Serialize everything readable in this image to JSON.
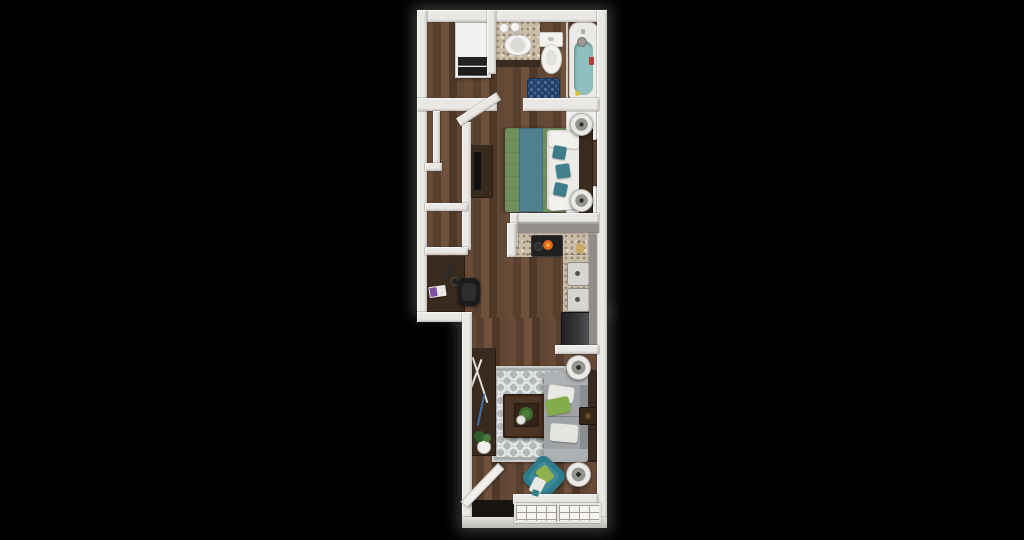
{
  "scene": {
    "description": "Top-down 3D rendered floor plan of a narrow studio apartment centered on a black background",
    "background": "#000000"
  },
  "palette": {
    "wall_white": "#eae8e5",
    "kitchen_wall_gray": "#908d8a",
    "wood_floor": "#5c4232",
    "granite_counter": "#c9bda9",
    "rug_gray": "#b4b8b9",
    "sofa_gray": "#9fa3a5",
    "bed_green": "#6e8e5e",
    "bed_teal_runner": "#50808d",
    "accent_chair_teal": "#2f7b8b",
    "pillow_green": "#83ad4a",
    "bath_mat_navy": "#223f66",
    "tub_teal": "#8fc0bf",
    "dark_wood_furniture": "#392a1e",
    "appliance_black": "#242424",
    "burner_orange": "#e06a1a",
    "white_fixture": "#f2f1ef"
  },
  "rooms": {
    "laundry": "Laundry closet with stacked washer and dryer",
    "bathroom": "Bathroom",
    "bedroom": "Sleeping area",
    "closets": "Closet compartments",
    "kitchen": "Kitchen",
    "desk_nook": "Desk nook",
    "living": "Living area",
    "entry": "Entry with open door"
  },
  "furniture": {
    "washer_dryer": "Stacked washer and dryer",
    "vanity": "Granite vanity with sink and faucet",
    "toilet": "Toilet",
    "bath_mat": "Navy patterned bath mat",
    "bathtub": "Bathtub with shower head",
    "bed": "Bed with green comforter, teal runner and pillows",
    "headboard": "Dark wood headboard",
    "nightstand_top": "Nightstand with round lamp",
    "nightstand_bottom": "Nightstand with round lamp",
    "dresser_tv": "Dresser with TV",
    "desk": "Desk with laptop and task lamp",
    "office_chair": "Black office chair",
    "range": "Range with glowing burner",
    "counter_top": "Granite kitchen counter",
    "counter_right": "Granite counter with double sink",
    "kitchen_sink": "Double-basin sink",
    "refrigerator": "Refrigerator",
    "sofa": "Gray sofa with green and white pillows",
    "coffee_table": "Dark wood coffee table with greenery centerpiece",
    "area_rug": "Gray quatrefoil area rug",
    "console_table": "Console table with branches and plant",
    "media_console": "Media console along wall",
    "side_table": "Small side table",
    "floor_lamp_top": "Round floor lamp",
    "floor_lamp_bottom": "Round floor lamp",
    "accent_chair": "Teal accent chair with green pillow and white throw",
    "potted_plant": "Potted plant",
    "entry_door": "Open entry door",
    "window_left": "Paned window",
    "window_right": "Paned window"
  }
}
